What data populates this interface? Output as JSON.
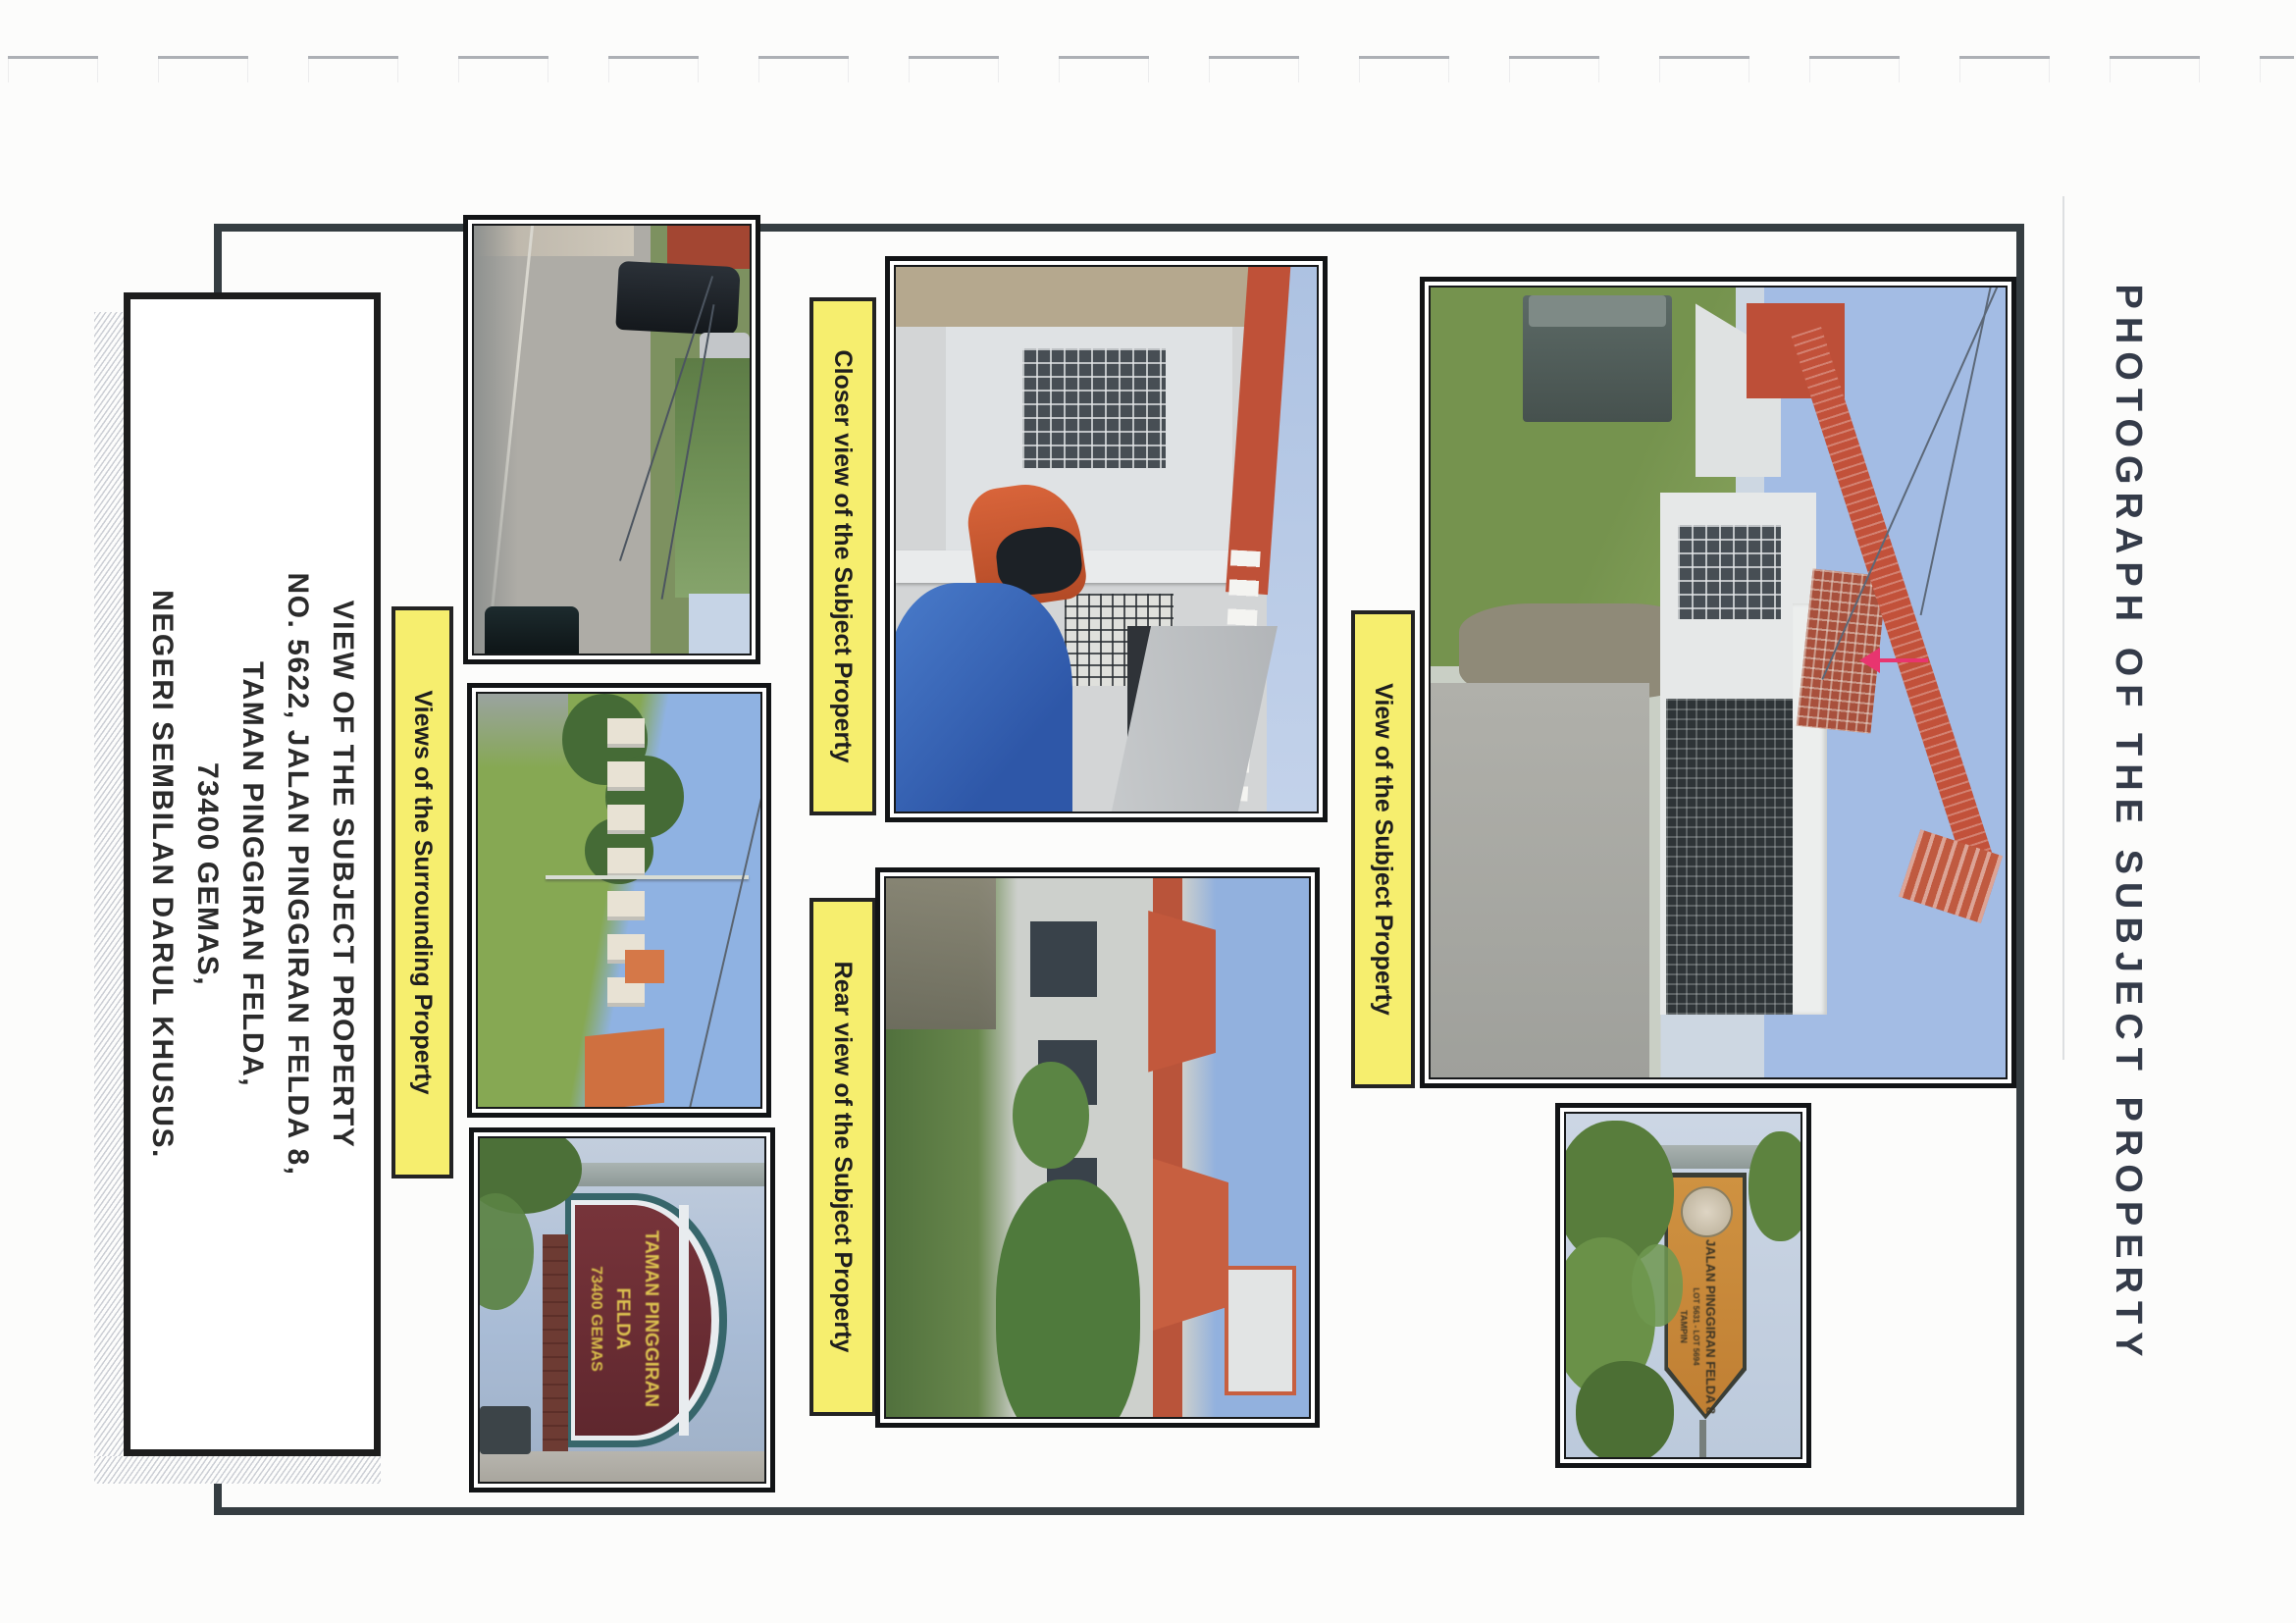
{
  "document": {
    "side_title": "PHOTOGRAPH OF THE SUBJECT PROPERTY",
    "address_box": {
      "lines": [
        "VIEW OF THE SUBJECT PROPERTY",
        "NO. 5622, JALAN PINGGIRAN FELDA 8,",
        "TAMAN PINGGIRAN FELDA,",
        "73400 GEMAS,",
        "NEGERI SEMBILAN DARUL KHUSUS."
      ]
    },
    "captions": {
      "surrounding": "Views of the Surrounding Property",
      "closer": "Closer view of the Subject Property",
      "rear": "Rear view of the Subject Property",
      "subject": "View of the Subject Property"
    },
    "photo_signboard": {
      "lines": [
        "TAMAN PINGGIRAN",
        "FELDA",
        "73400 GEMAS"
      ]
    },
    "photo_roadsign": {
      "lines": [
        "JALAN PINGGIRAN FELDA 8",
        "LOT 5631 - LOT 5694",
        "TAMPIN"
      ]
    },
    "annotation_arrow": {
      "direction": "left",
      "color": "#e8356f"
    },
    "colors": {
      "caption_background": "#f6ee6e",
      "arrow": "#e8356f",
      "title_text": "#343b49",
      "page_border": "#353d41",
      "photo_frame": "#121416"
    }
  }
}
